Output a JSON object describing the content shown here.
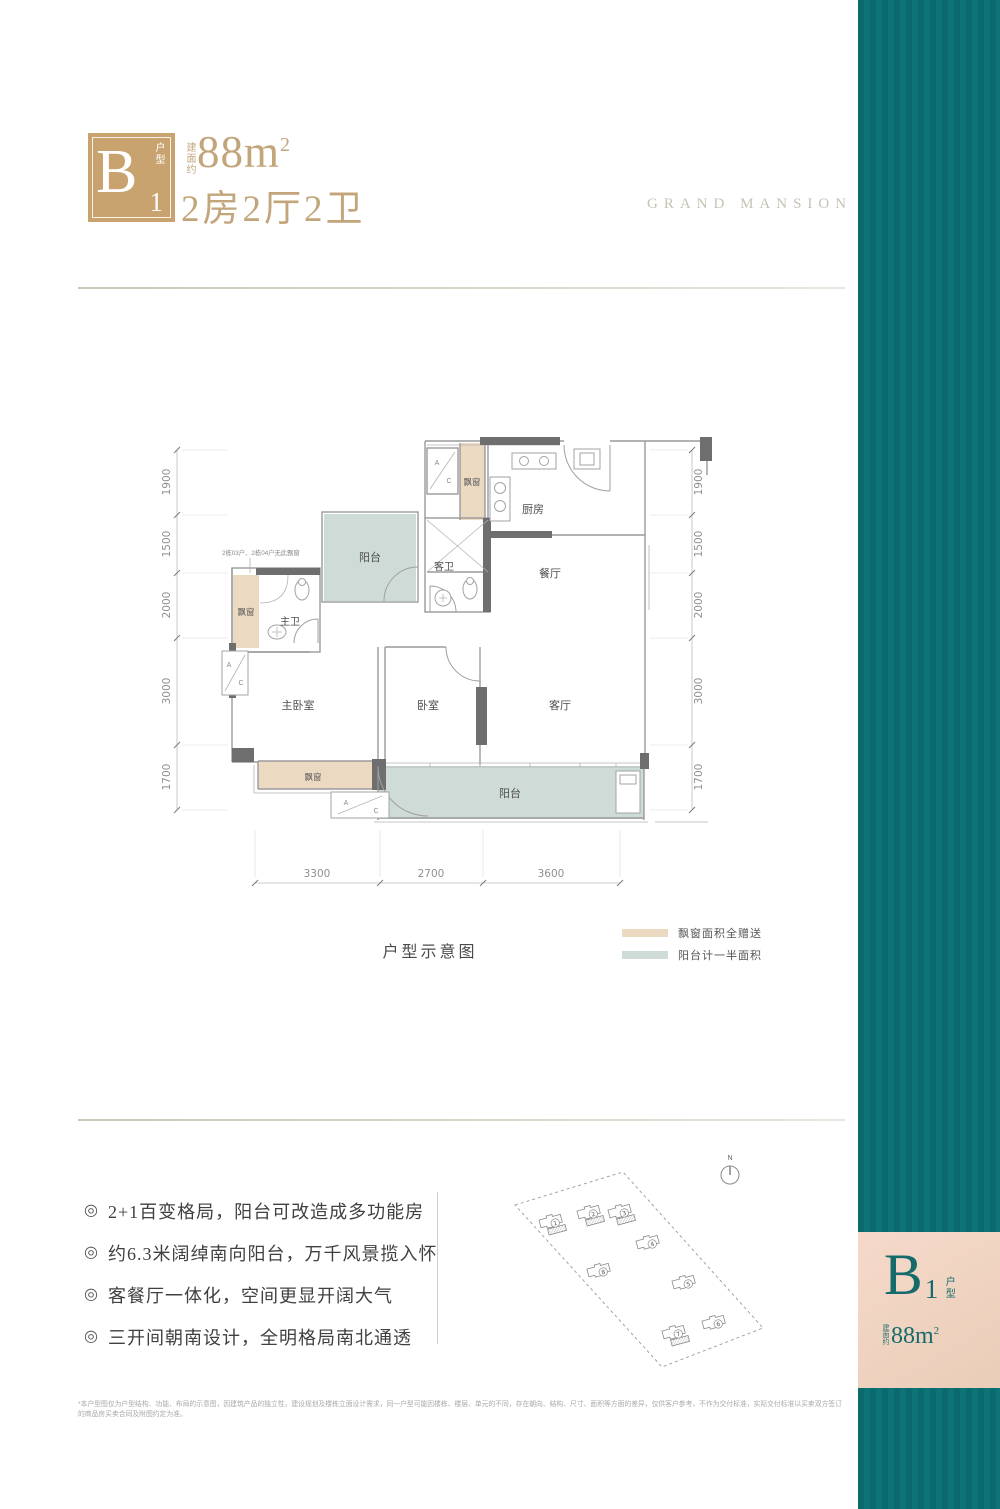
{
  "header": {
    "badge_letter": "B",
    "badge_number": "1",
    "badge_unit": "户型",
    "area_prefix": "建面约",
    "area_value": "88m",
    "area_sup": "2",
    "layout_text": "2房2厅2卫",
    "brand": "GRAND MANSION"
  },
  "plan": {
    "rooms": {
      "kitchen": "厨房",
      "dining": "餐厅",
      "guest_bath": "客卫",
      "master_bath": "主卫",
      "balcony_north": "阳台",
      "balcony_south": "阳台",
      "master_bedroom": "主卧室",
      "bedroom": "卧室",
      "living": "客厅",
      "bay_window_top": "飘窗",
      "bay_window_left": "飘窗",
      "bay_window_bottom": "飘窗",
      "ac_a": "A",
      "ac_c": "C"
    },
    "note": "2栋03户、2栋04户无此飘窗",
    "dims_left": [
      "1900",
      "1500",
      "2000",
      "3000",
      "1700"
    ],
    "dims_right": [
      "1900",
      "1500",
      "2000",
      "3000",
      "1700"
    ],
    "dims_bottom": [
      "3300",
      "2700",
      "3600"
    ],
    "caption": "户型示意图"
  },
  "legend": {
    "items": [
      {
        "label": "飘窗面积全赠送",
        "color": "#ecd9c1"
      },
      {
        "label": "阳台计一半面积",
        "color": "#cfdbd7"
      }
    ]
  },
  "features": {
    "bullet": "◎",
    "items": [
      "2+1百变格局，阳台可改造成多功能房",
      "约6.3米阔绰南向阳台，万千风景揽入怀",
      "客餐厅一体化，空间更显开阔大气",
      "三开间朝南设计，全明格局南北通透"
    ]
  },
  "siteplan": {
    "north": "N",
    "buildings": [
      "1",
      "2",
      "3",
      "4",
      "5",
      "6",
      "7",
      "8"
    ]
  },
  "sidebar": {
    "badge_letter": "B",
    "badge_number": "1",
    "badge_unit": "户型",
    "area_prefix": "建面约",
    "area_value": "88m",
    "area_sup": "2"
  },
  "colors": {
    "accent_gold": "#c8a370",
    "teal_sidebar": "#0c6e72",
    "bay_window": "#ecd9c1",
    "balcony": "#cfdbd7",
    "badge_peach": "#f3d5c3"
  },
  "disclaimer": "*本户型图仅为户型结构、功能、布局的示意图，因建筑产品的独立性，建设规划及楼栋立面设计需求，同一户型可能因楼栋、楼层、单元的不同，存在朝向、结构、尺寸、面积等方面的差异，仅供客户参考，不作为交付标准，实际交付标准以买卖双方签订的商品房买卖合同及附图约定为准。"
}
